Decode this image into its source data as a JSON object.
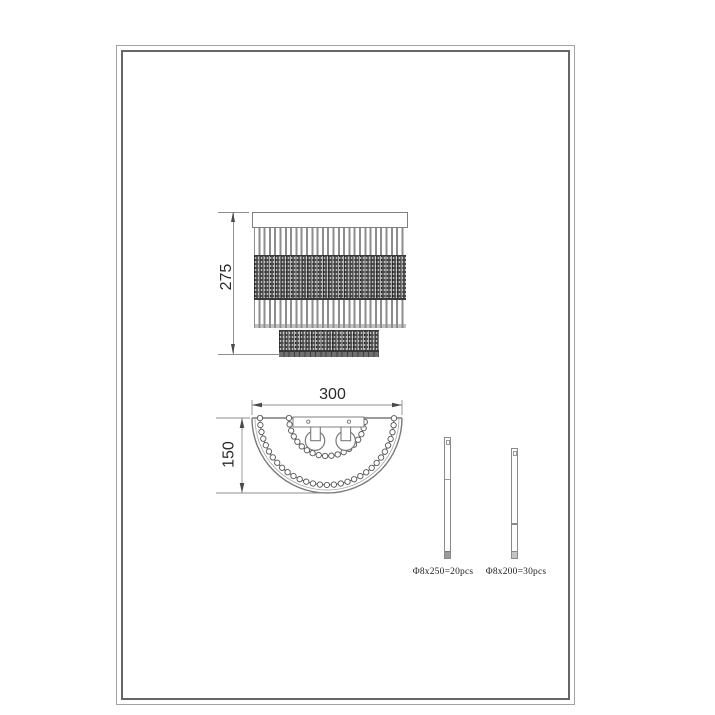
{
  "drawing": {
    "front_view": {
      "height_label": "275"
    },
    "top_view": {
      "width_label": "300",
      "depth_label": "150"
    },
    "rod_details": [
      {
        "label": "Φ8x250=20pcs"
      },
      {
        "label": "Φ8x200=30pcs"
      }
    ],
    "colors": {
      "line": "#8f8f8f",
      "crystal_band": "#4a4a4a",
      "text": "#2a2a2a",
      "frame": "#666666"
    }
  }
}
